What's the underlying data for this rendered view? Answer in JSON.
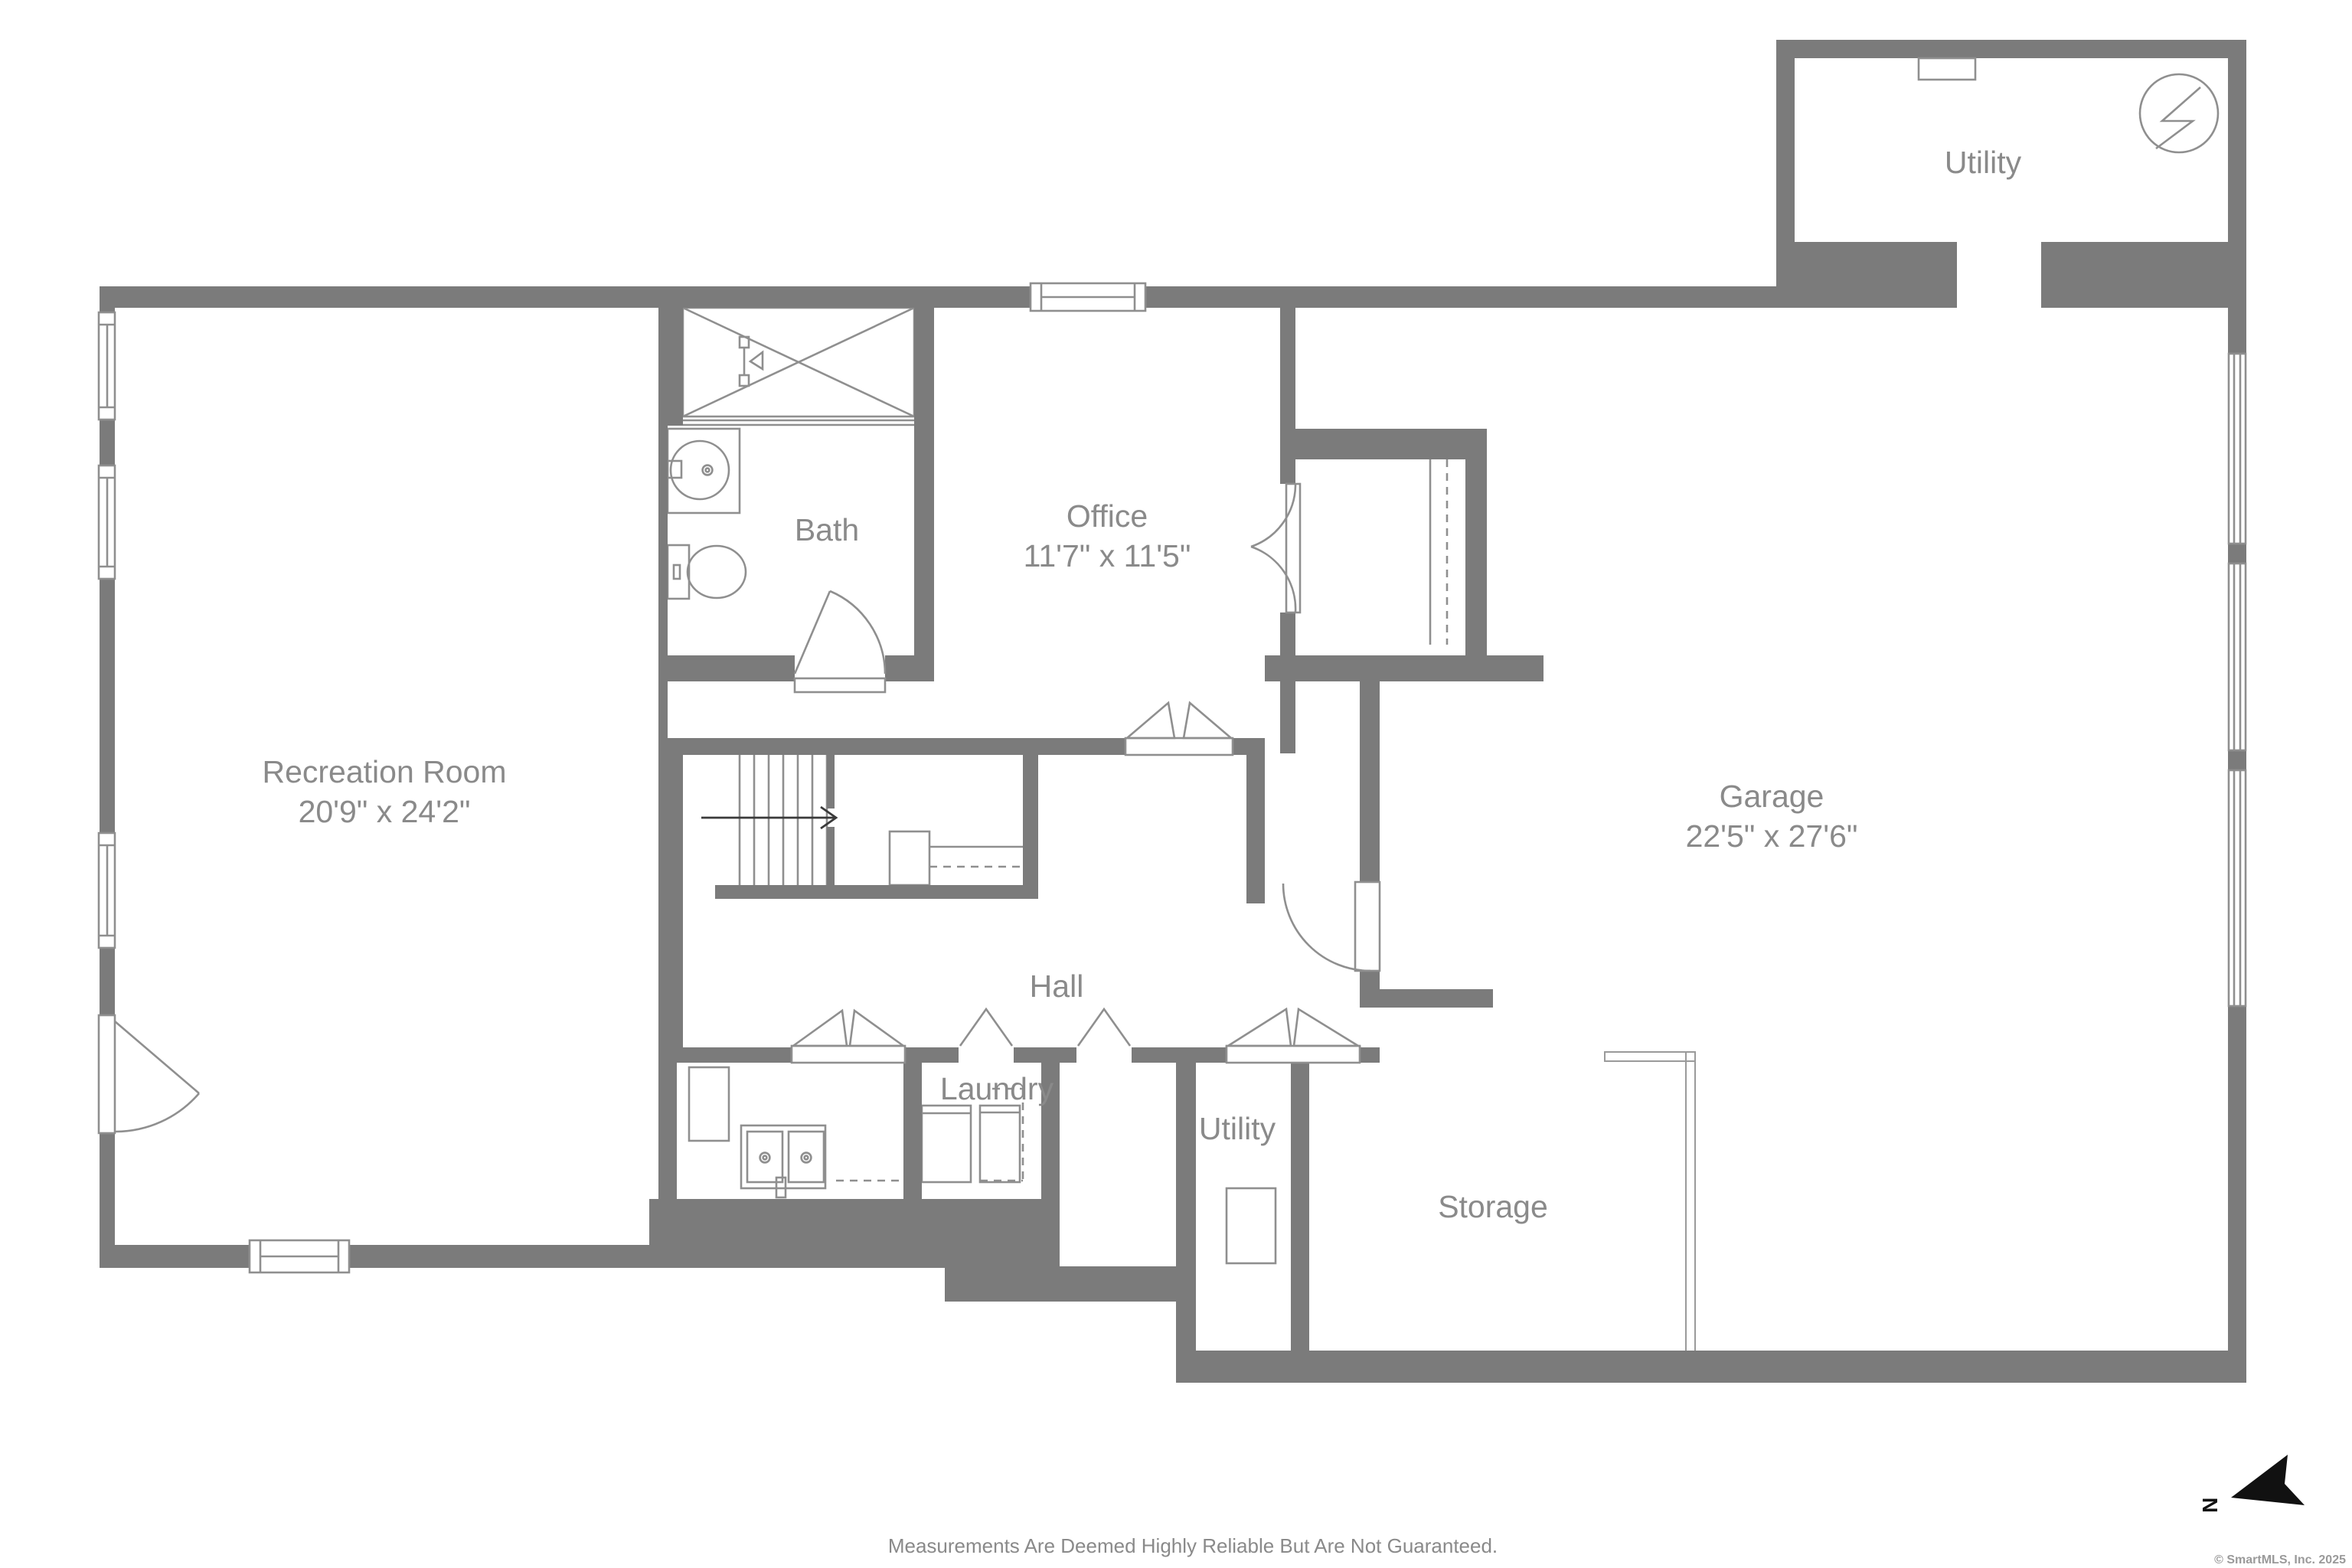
{
  "plan": {
    "rooms": [
      {
        "id": "recreation-room",
        "label": "Recreation Room",
        "dims": "20'9\" x 24'2\""
      },
      {
        "id": "bath",
        "label": "Bath",
        "dims": ""
      },
      {
        "id": "office",
        "label": "Office",
        "dims": "11'7\" x 11'5\""
      },
      {
        "id": "garage",
        "label": "Garage",
        "dims": "22'5\" x 27'6\""
      },
      {
        "id": "hall",
        "label": "Hall",
        "dims": ""
      },
      {
        "id": "laundry",
        "label": "Laundry",
        "dims": ""
      },
      {
        "id": "utility-top",
        "label": "Utility",
        "dims": ""
      },
      {
        "id": "utility-bottom",
        "label": "Utility",
        "dims": ""
      },
      {
        "id": "storage",
        "label": "Storage",
        "dims": ""
      }
    ],
    "footer": {
      "disclaimer": "Measurements Are Deemed Highly Reliable But Are Not Guaranteed."
    },
    "compass": {
      "label": "N"
    },
    "credit": "© SmartMLS, Inc.  2025",
    "colors": {
      "wall": "#7b7b7b",
      "fixture_line": "#8f8f8f",
      "label_text": "#8a8a8a",
      "background": "#ffffff",
      "north_arrow": "#111111"
    }
  }
}
